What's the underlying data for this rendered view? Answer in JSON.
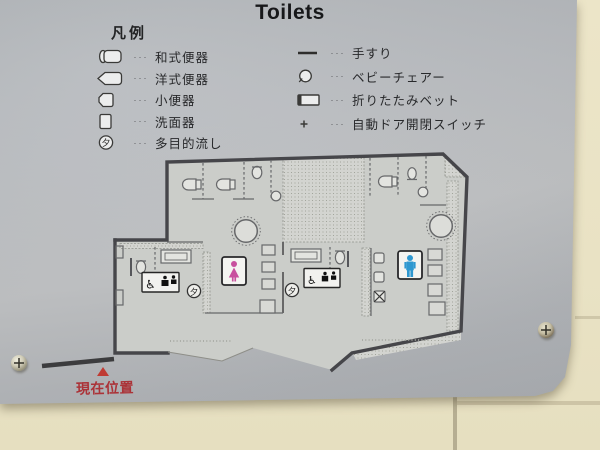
{
  "sign": {
    "title": "Toilets",
    "legend": {
      "header": "凡例",
      "leader": "···",
      "left_items": [
        {
          "icon": "squat-toilet-icon",
          "label": "和式便器"
        },
        {
          "icon": "western-toilet-icon",
          "label": "洋式便器"
        },
        {
          "icon": "urinal-icon",
          "label": "小便器"
        },
        {
          "icon": "washbasin-icon",
          "label": "洗面器"
        },
        {
          "icon": "multipurpose-sink-icon",
          "label": "多目的流し",
          "icon_char": "夕"
        }
      ],
      "right_items": [
        {
          "icon": "handrail-icon",
          "label": "手すり"
        },
        {
          "icon": "baby-chair-icon",
          "label": "ベビーチェアー"
        },
        {
          "icon": "folding-bed-icon",
          "label": "折りたたみベット"
        },
        {
          "icon": "auto-door-switch-icon",
          "label": "自動ドア開閉スイッチ",
          "icon_char": "+"
        }
      ]
    },
    "floorplan": {
      "multipurpose_markers": [
        "夕",
        "夕"
      ],
      "accessible_markers": [
        "♿",
        "♿"
      ],
      "womens_symbol": "woman-pictogram",
      "mens_symbol": "man-pictogram"
    },
    "current_location": {
      "marker": "▲",
      "label": "現在位置"
    }
  },
  "colors": {
    "panel_gray": "#b9bcc0",
    "wall_beige": "#e9e2c4",
    "plan_wall": "#46464a",
    "women_pink": "#c8509e",
    "men_blue": "#2f98d0",
    "location_red": "#ab3338"
  }
}
